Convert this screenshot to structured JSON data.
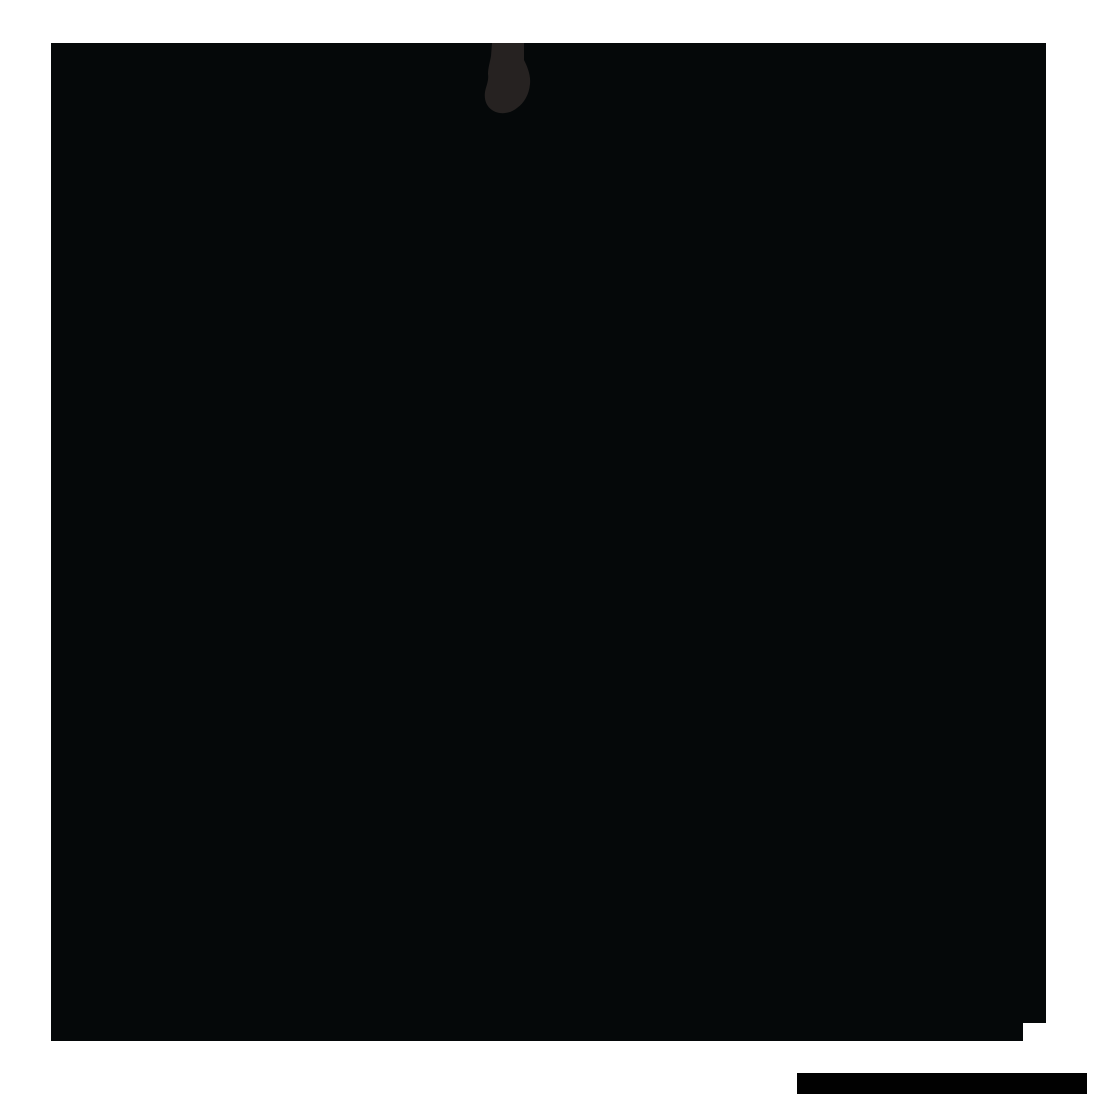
{
  "window": {
    "background": "#ffffff"
  },
  "photo": {
    "fill": "#050809",
    "obstruction_fill": "#262221"
  },
  "corner_notch": {
    "fill": "#ffffff"
  },
  "footer_bar": {
    "fill": "#010101"
  }
}
